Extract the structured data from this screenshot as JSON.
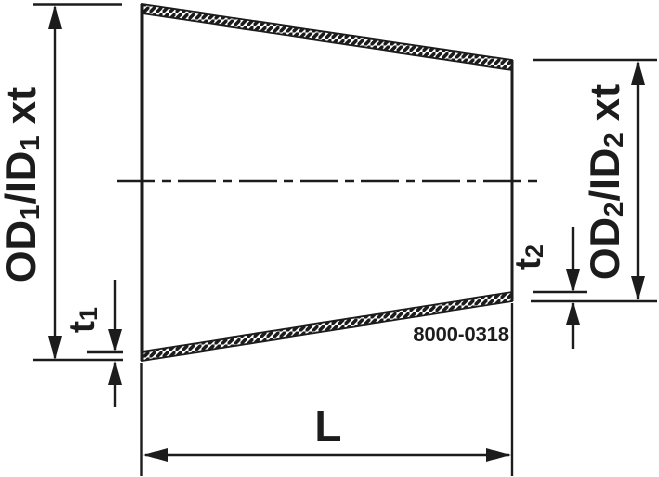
{
  "drawing": {
    "description": "concentric reducer technical drawing",
    "part_number": "8000-0318",
    "labels": {
      "od1": {
        "prefix": "OD",
        "sub1": "1",
        "mid": "/ID",
        "sub2": "1",
        "suffix": "xt"
      },
      "od2": {
        "prefix": "OD",
        "sub1": "2",
        "mid": "/ID",
        "sub2": "2",
        "suffix": "xt"
      },
      "t1": {
        "prefix": "t",
        "sub": "1"
      },
      "t2": {
        "prefix": "t",
        "sub": "2"
      },
      "length": "L"
    }
  },
  "colors": {
    "ink": "#1c1c1c",
    "background": "#ffffff"
  }
}
